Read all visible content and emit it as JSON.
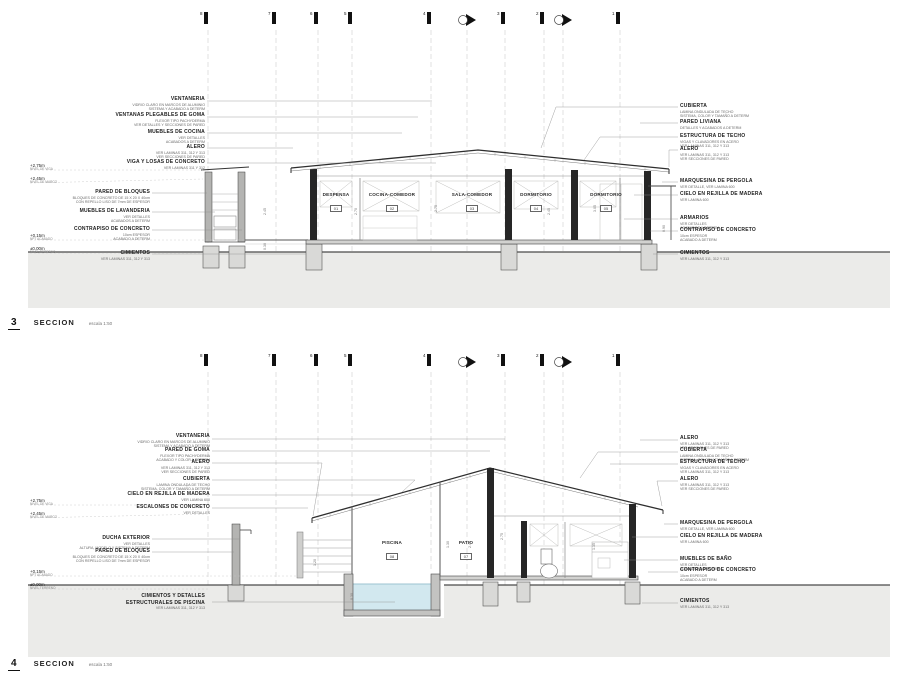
{
  "palette": {
    "ground": "#ebebe9",
    "water": "#d2e8ef",
    "wall_dark": "#262626",
    "line": "#4a4a4a"
  },
  "sections": [
    {
      "id": "3",
      "title": "SECCION",
      "scale": "escala 1:50",
      "grid": {
        "labels": [
          "8",
          "7",
          "6",
          "5",
          "4",
          "3",
          "2",
          "1"
        ]
      },
      "elevation_tags": [
        {
          "value": "+2.75m",
          "note": "NIVEL DE VIGA"
        },
        {
          "value": "+2.45m",
          "note": "NIVEL DE MARCO"
        },
        {
          "value": "+0.15m",
          "note": "NPT ACABADO"
        },
        {
          "value": "±0.00m",
          "note": "NIVEL TERRENO"
        }
      ],
      "left_labels": [
        {
          "title": "VENTANERIA",
          "lines": [
            "VIDRIO CLARO EN MARCOS DE ALUMINIO",
            "SISTEMA Y ACABADO A DETERM"
          ]
        },
        {
          "title": "VENTANAS PLEGABLES DE GOMA",
          "lines": [
            "FLEXOR TIPO PACHYDERMA",
            "VER DETALLES Y SECCIONES DE PARED"
          ]
        },
        {
          "title": "MUEBLES DE COCINA",
          "lines": [
            "VER DETALLES",
            "ACABADOS A DETERM"
          ]
        },
        {
          "title": "ALERO",
          "lines": [
            "VER LAMINAS 311, 312 Y 313",
            "VER SECCIONES DE PARED"
          ]
        },
        {
          "title": "VIGA Y LOSAS DE CONCRETO",
          "lines": [
            "VER LAMINAS 311 Y 312"
          ]
        },
        {
          "title": "PARED DE BLOQUES",
          "lines": [
            "BLOQUES DE CONCRETO DE 15 X 20 X 40cm",
            "CON REPELLO LISO DE 7mm DE ESPESOR"
          ]
        },
        {
          "title": "MUEBLES DE LAVANDERIA",
          "lines": [
            "VER DETALLES",
            "ACABADOS A DETERM"
          ]
        },
        {
          "title": "CONTRAPISO DE CONCRETO",
          "lines": [
            "10cm ESPESOR",
            "ACABADO A DETERM"
          ]
        },
        {
          "title": "CIMIENTOS",
          "lines": [
            "VER LAMINAS 311, 312 Y 313"
          ]
        }
      ],
      "right_labels": [
        {
          "title": "CUBIERTA",
          "lines": [
            "LAMINA ONDULADA DE TECHO",
            "SISTEMA, COLOR Y TAMAÑO A DETERM"
          ]
        },
        {
          "title": "PARED LIVIANA",
          "lines": [
            "DETALLES Y ACABADOS A DETERM"
          ]
        },
        {
          "title": "ESTRUCTURA DE TECHO",
          "lines": [
            "VIGAS Y CLAVADORES EN ACERO",
            "VER LAMINAS 311, 312 Y 313"
          ]
        },
        {
          "title": "ALERO",
          "lines": [
            "VER LAMINAS 311, 312 Y 313",
            "VER SECCIONES DE PARED"
          ]
        },
        {
          "title": "MARQUESINA DE PERGOLA",
          "lines": [
            "VER DETALLE, VER LAMINA 600"
          ]
        },
        {
          "title": "CIELO EN REJILLA DE MADERA",
          "lines": [
            "VER LAMINA 600"
          ]
        },
        {
          "title": "ARMARIOS",
          "lines": [
            "VER DETALLES",
            "ACABADOS A DETERM"
          ]
        },
        {
          "title": "CONTRAPISO DE CONCRETO",
          "lines": [
            "10cm ESPESOR",
            "ACABADO A DETERM"
          ]
        },
        {
          "title": "CIMIENTOS",
          "lines": [
            "VER LAMINAS 311, 312 Y 313"
          ]
        }
      ],
      "rooms": [
        {
          "name": "DESPENSA",
          "number": "01"
        },
        {
          "name": "COCINA-COMEDOR",
          "number": "02"
        },
        {
          "name": "SALA-COMEDOR",
          "number": "03"
        },
        {
          "name": "DORMITORIO",
          "number": "04"
        },
        {
          "name": "DORMITORIO",
          "number": "05"
        }
      ],
      "dims": [
        "2.45",
        "0.30",
        "2.70",
        "2.75",
        "2.45",
        "3.05",
        "0.90"
      ]
    },
    {
      "id": "4",
      "title": "SECCION",
      "scale": "escala 1:50",
      "grid": {
        "labels": [
          "8",
          "7",
          "6",
          "5",
          "4",
          "3",
          "2",
          "1"
        ]
      },
      "elevation_tags": [
        {
          "value": "+2.75m",
          "note": "NIVEL DE VIGA"
        },
        {
          "value": "+2.45m",
          "note": "NIVEL DE MARCO"
        },
        {
          "value": "+0.15m",
          "note": "NPT ACABADO"
        },
        {
          "value": "±0.00m",
          "note": "NIVEL TERRENO"
        }
      ],
      "left_labels": [
        {
          "title": "VENTANERIA",
          "lines": [
            "VIDRIO CLARO EN MARCOS DE ALUMINIO",
            "SISTEMA Y ACABADO A DETERM"
          ]
        },
        {
          "title": "PARED DE GOMA",
          "lines": [
            "FLEXOR TIPO PACHYDERMA",
            "ACABADO Y COLOR A DETERM"
          ]
        },
        {
          "title": "ALERO",
          "lines": [
            "VER LAMINAS 311, 312 Y 313",
            "VER SECCIONES DE PARED"
          ]
        },
        {
          "title": "CUBIERTA",
          "lines": [
            "LAMINA ONDULADA DE TECHO",
            "SISTEMA, COLOR Y TAMAÑO A DETERM"
          ]
        },
        {
          "title": "CIELO EN REJILLA DE MADERA",
          "lines": [
            "VER LAMINA 600"
          ]
        },
        {
          "title": "ESCALONES DE CONCRETO",
          "lines": [
            "VER DETALLES"
          ]
        },
        {
          "title": "DUCHA EXTERIOR",
          "lines": [
            "VER DETALLES",
            "ALTURA, MODELO Y SISTEMA A DETERM"
          ]
        },
        {
          "title": "PARED DE BLOQUES",
          "lines": [
            "BLOQUES DE CONCRETO DE 15 X 20 X 40cm",
            "CON REPELLO LISO DE 7mm DE ESPESOR"
          ]
        },
        {
          "title": "CIMIENTOS Y DETALLES ESTRUCTURALES DE PISCINA",
          "lines": [
            "VER LAMINAS 311, 312 Y 313"
          ]
        }
      ],
      "right_labels": [
        {
          "title": "ALERO",
          "lines": [
            "VER LAMINAS 311, 312 Y 313",
            "VER SECCIONES DE PARED"
          ]
        },
        {
          "title": "CUBIERTA",
          "lines": [
            "LAMINA ONDULADA DE TECHO",
            "SISTEMA, COLOR Y TAMAÑO A DETERM"
          ]
        },
        {
          "title": "ESTRUCTURA DE TECHO",
          "lines": [
            "VIGAS Y CLAVADORES EN ACERO",
            "VER LAMINAS 311, 312 Y 313"
          ]
        },
        {
          "title": "ALERO",
          "lines": [
            "VER LAMINAS 311, 312 Y 313",
            "VER SECCIONES DE PARED"
          ]
        },
        {
          "title": "MARQUESINA DE PERGOLA",
          "lines": [
            "VER DETALLE, VER LAMINA 600"
          ]
        },
        {
          "title": "CIELO EN REJILLA DE MADERA",
          "lines": [
            "VER LAMINA 600"
          ]
        },
        {
          "title": "MUEBLES DE BAÑO",
          "lines": [
            "VER DETALLES",
            "ACABADOS A DETERM"
          ]
        },
        {
          "title": "CONTRAPISO DE CONCRETO",
          "lines": [
            "10cm ESPESOR",
            "ACABADO A DETERM"
          ]
        },
        {
          "title": "CIMIENTOS",
          "lines": [
            "VER LAMINAS 311, 312 Y 313"
          ]
        }
      ],
      "rooms": [
        {
          "name": "PISCINA",
          "number": "08"
        },
        {
          "name": "PATIO",
          "number": "07"
        }
      ],
      "dims": [
        "1.20",
        "2.45",
        "2.75",
        "1.35",
        "1.30",
        "0.30"
      ]
    }
  ]
}
